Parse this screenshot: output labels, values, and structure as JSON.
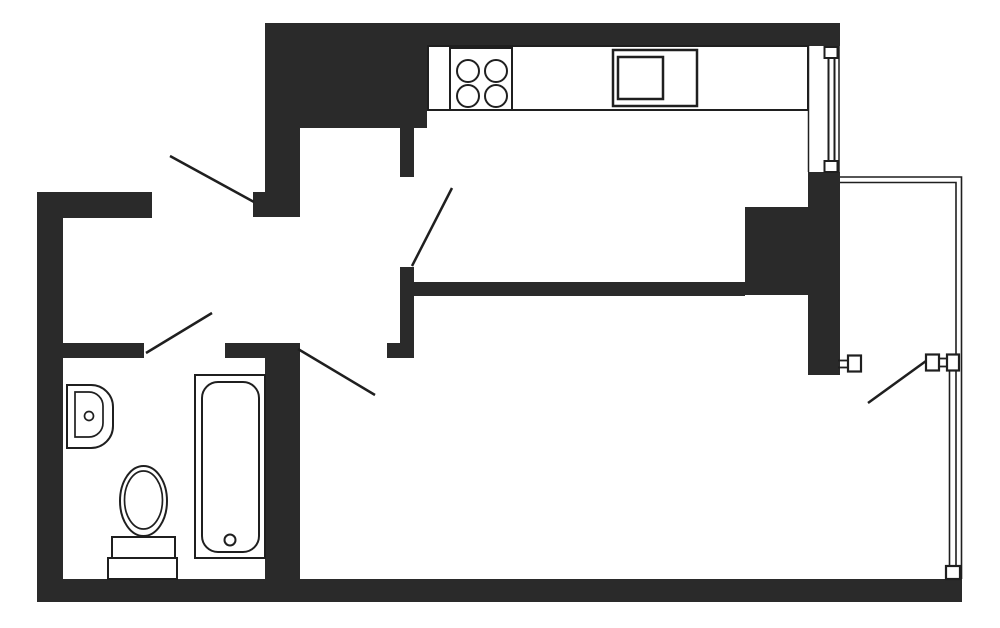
{
  "meta": {
    "description": "apartment floor plan, black walls on white, one-room flat with kitchen, bathroom, hallway and glazed balcony",
    "canvas": {
      "width": 1000,
      "height": 628,
      "background": "#ffffff"
    }
  },
  "colors": {
    "wall": "#2a2a2a",
    "line": "#1f1f1f",
    "white": "#ffffff",
    "none": "none"
  },
  "shapes": [
    {
      "name": "wall-top",
      "type": "rect",
      "x": 265,
      "y": 23,
      "w": 575,
      "h": 23,
      "fill": "wall"
    },
    {
      "name": "wall-kitchen-nw-mass",
      "type": "rect",
      "x": 265,
      "y": 23,
      "w": 162,
      "h": 105,
      "fill": "wall"
    },
    {
      "name": "wall-entry-upper",
      "type": "rect",
      "x": 265,
      "y": 128,
      "w": 35,
      "h": 89,
      "fill": "wall"
    },
    {
      "name": "wall-entry-step",
      "type": "rect",
      "x": 253,
      "y": 192,
      "w": 12,
      "h": 25,
      "fill": "wall"
    },
    {
      "name": "wall-top-left",
      "type": "rect",
      "x": 37,
      "y": 192,
      "w": 115,
      "h": 26,
      "fill": "wall"
    },
    {
      "name": "wall-left",
      "type": "rect",
      "x": 37,
      "y": 192,
      "w": 26,
      "h": 410,
      "fill": "wall"
    },
    {
      "name": "wall-bottom",
      "type": "rect",
      "x": 37,
      "y": 579,
      "w": 925,
      "h": 23,
      "fill": "wall"
    },
    {
      "name": "wall-bath-top-left",
      "type": "rect",
      "x": 63,
      "y": 343,
      "w": 81,
      "h": 15,
      "fill": "wall"
    },
    {
      "name": "wall-bath-top-right",
      "type": "rect",
      "x": 225,
      "y": 343,
      "w": 75,
      "h": 15,
      "fill": "wall"
    },
    {
      "name": "wall-bath-east",
      "type": "rect",
      "x": 265,
      "y": 343,
      "w": 35,
      "h": 236,
      "fill": "wall"
    },
    {
      "name": "wall-kitchen-door-stub",
      "type": "rect",
      "x": 400,
      "y": 128,
      "w": 14,
      "h": 49,
      "fill": "wall"
    },
    {
      "name": "wall-kitchen-door-lower",
      "type": "rect",
      "x": 400,
      "y": 267,
      "w": 14,
      "h": 91,
      "fill": "wall"
    },
    {
      "name": "wall-kitchen-door-foot",
      "type": "rect",
      "x": 387,
      "y": 343,
      "w": 27,
      "h": 15,
      "fill": "wall"
    },
    {
      "name": "wall-kitchen-living",
      "type": "rect",
      "x": 414,
      "y": 282,
      "w": 331,
      "h": 14,
      "fill": "wall"
    },
    {
      "name": "wall-living-pier",
      "type": "rect",
      "x": 745,
      "y": 207,
      "w": 65,
      "h": 88,
      "fill": "wall"
    },
    {
      "name": "wall-right",
      "type": "rect",
      "x": 808,
      "y": 172,
      "w": 32,
      "h": 203,
      "fill": "wall"
    },
    {
      "name": "kitchen-counter",
      "type": "rect",
      "x": 428,
      "y": 46,
      "w": 380,
      "h": 64,
      "fill": "white",
      "stroke": "line",
      "sw": 2
    },
    {
      "name": "stove",
      "type": "rect",
      "x": 450,
      "y": 48,
      "w": 62,
      "h": 62,
      "fill": "white",
      "stroke": "line",
      "sw": 2
    },
    {
      "name": "stove-burner-1",
      "type": "circle",
      "cx": 468,
      "cy": 71,
      "r": 11,
      "fill": "white",
      "stroke": "line",
      "sw": 2
    },
    {
      "name": "stove-burner-2",
      "type": "circle",
      "cx": 496,
      "cy": 71,
      "r": 11,
      "fill": "white",
      "stroke": "line",
      "sw": 2
    },
    {
      "name": "stove-burner-3",
      "type": "circle",
      "cx": 468,
      "cy": 96,
      "r": 11,
      "fill": "white",
      "stroke": "line",
      "sw": 2
    },
    {
      "name": "stove-burner-4",
      "type": "circle",
      "cx": 496,
      "cy": 96,
      "r": 11,
      "fill": "white",
      "stroke": "line",
      "sw": 2
    },
    {
      "name": "kitchen-sink-unit",
      "type": "rect",
      "x": 613,
      "y": 50,
      "w": 84,
      "h": 56,
      "fill": "white",
      "stroke": "line",
      "sw": 2.5
    },
    {
      "name": "kitchen-sink-basin",
      "type": "rect",
      "x": 618,
      "y": 57,
      "w": 45,
      "h": 42,
      "fill": "none",
      "stroke": "line",
      "sw": 2.5
    },
    {
      "name": "window-bay-line-left",
      "type": "line",
      "x1": 808.5,
      "y1": 46,
      "x2": 808.5,
      "y2": 172,
      "stroke": "line",
      "sw": 1.5
    },
    {
      "name": "window-bay-line-right",
      "type": "line",
      "x1": 839,
      "y1": 46,
      "x2": 839,
      "y2": 172,
      "stroke": "line",
      "sw": 1.5
    },
    {
      "name": "window-frame-left",
      "type": "line",
      "x1": 828.5,
      "y1": 57,
      "x2": 828.5,
      "y2": 162,
      "stroke": "line",
      "sw": 2
    },
    {
      "name": "window-frame-right",
      "type": "line",
      "x1": 834.5,
      "y1": 57,
      "x2": 834.5,
      "y2": 162,
      "stroke": "line",
      "sw": 2
    },
    {
      "name": "window-sill-top",
      "type": "rect",
      "x": 824.5,
      "y": 47,
      "w": 13,
      "h": 11,
      "fill": "white",
      "stroke": "line",
      "sw": 2
    },
    {
      "name": "window-sill-bottom",
      "type": "rect",
      "x": 824.5,
      "y": 161,
      "w": 13,
      "h": 11,
      "fill": "white",
      "stroke": "line",
      "sw": 2
    },
    {
      "name": "balcony-railing-outer",
      "type": "polyline",
      "points": "840,177 961.5,177 961.5,579",
      "fill": "none",
      "stroke": "line",
      "sw": 1.6
    },
    {
      "name": "balcony-railing-inner",
      "type": "polyline",
      "points": "840,182.5 956,182.5 956,579",
      "fill": "none",
      "stroke": "line",
      "sw": 1.6
    },
    {
      "name": "balcony-glazing-line",
      "type": "line",
      "x1": 949.5,
      "y1": 370,
      "x2": 949.5,
      "y2": 567,
      "stroke": "line",
      "sw": 1.6
    },
    {
      "name": "balcony-door-link-l1",
      "type": "line",
      "x1": 838,
      "y1": 360.5,
      "x2": 848,
      "y2": 360.5,
      "stroke": "line",
      "sw": 1.8
    },
    {
      "name": "balcony-door-link-l2",
      "type": "line",
      "x1": 838,
      "y1": 367.5,
      "x2": 848,
      "y2": 367.5,
      "stroke": "line",
      "sw": 1.8
    },
    {
      "name": "balcony-door-link-r1",
      "type": "line",
      "x1": 939,
      "y1": 358.5,
      "x2": 947,
      "y2": 358.5,
      "stroke": "line",
      "sw": 1.8
    },
    {
      "name": "balcony-door-link-r2",
      "type": "line",
      "x1": 939,
      "y1": 366.5,
      "x2": 947,
      "y2": 366.5,
      "stroke": "line",
      "sw": 1.8
    },
    {
      "name": "balcony-door-jamb-left",
      "type": "rect",
      "x": 848,
      "y": 355.5,
      "w": 13,
      "h": 16,
      "fill": "white",
      "stroke": "line",
      "sw": 2.2
    },
    {
      "name": "balcony-door-jamb-right",
      "type": "rect",
      "x": 926,
      "y": 354.5,
      "w": 13,
      "h": 16,
      "fill": "white",
      "stroke": "line",
      "sw": 2.2
    },
    {
      "name": "balcony-glazing-jamb",
      "type": "rect",
      "x": 947,
      "y": 354.5,
      "w": 12,
      "h": 16,
      "fill": "white",
      "stroke": "line",
      "sw": 2.2
    },
    {
      "name": "balcony-glazing-terminal",
      "type": "rect",
      "x": 946,
      "y": 566,
      "w": 14,
      "h": 13,
      "fill": "white",
      "stroke": "line",
      "sw": 2.2
    },
    {
      "name": "bath-sink-outer",
      "type": "path",
      "d": "M67,385 H91 A22,22 0 0 1 113,407 V426 A22,22 0 0 1 91,448 H67 Z",
      "fill": "white",
      "stroke": "line",
      "sw": 2
    },
    {
      "name": "bath-sink-inner",
      "type": "path",
      "d": "M75,392 H89 A14,14 0 0 1 103,406 V423 A14,14 0 0 1 89,437 H75 Z",
      "fill": "none",
      "stroke": "line",
      "sw": 1.7
    },
    {
      "name": "bath-sink-drain",
      "type": "circle",
      "cx": 89,
      "cy": 416,
      "r": 4.5,
      "fill": "white",
      "stroke": "line",
      "sw": 1.7
    },
    {
      "name": "toilet-base",
      "type": "rect",
      "x": 108,
      "y": 558,
      "w": 69,
      "h": 21,
      "fill": "white",
      "stroke": "line",
      "sw": 2
    },
    {
      "name": "toilet-tank",
      "type": "rect",
      "x": 112,
      "y": 537,
      "w": 63,
      "h": 21,
      "fill": "white",
      "stroke": "line",
      "sw": 2
    },
    {
      "name": "toilet-bowl-outer",
      "type": "ellipse",
      "cx": 143.5,
      "cy": 501,
      "rx": 23.5,
      "ry": 35,
      "fill": "white",
      "stroke": "line",
      "sw": 2
    },
    {
      "name": "toilet-bowl-inner",
      "type": "ellipse",
      "cx": 143.5,
      "cy": 500,
      "rx": 19,
      "ry": 29,
      "fill": "none",
      "stroke": "line",
      "sw": 1.7
    },
    {
      "name": "bathtub-outer",
      "type": "rect",
      "x": 195,
      "y": 375,
      "w": 70,
      "h": 183,
      "fill": "white",
      "stroke": "line",
      "sw": 2
    },
    {
      "name": "bathtub-inner",
      "type": "rect",
      "x": 202,
      "y": 382,
      "w": 57,
      "h": 170,
      "rx": 16,
      "fill": "none",
      "stroke": "line",
      "sw": 2
    },
    {
      "name": "bathtub-drain",
      "type": "circle",
      "cx": 230,
      "cy": 540,
      "r": 5.5,
      "fill": "white",
      "stroke": "line",
      "sw": 2
    },
    {
      "name": "entry-door-swing",
      "type": "line",
      "x1": 170,
      "y1": 156,
      "x2": 254,
      "y2": 202,
      "stroke": "line",
      "sw": 2.5
    },
    {
      "name": "kitchen-door-swing",
      "type": "line",
      "x1": 412,
      "y1": 266,
      "x2": 452,
      "y2": 188,
      "stroke": "line",
      "sw": 2.5
    },
    {
      "name": "bathroom-door-swing",
      "type": "line",
      "x1": 146,
      "y1": 353,
      "x2": 212,
      "y2": 313,
      "stroke": "line",
      "sw": 2.5
    },
    {
      "name": "living-door-swing",
      "type": "line",
      "x1": 298,
      "y1": 349,
      "x2": 375,
      "y2": 395,
      "stroke": "line",
      "sw": 2.5
    },
    {
      "name": "balcony-door-swing",
      "type": "line",
      "x1": 868,
      "y1": 403,
      "x2": 926,
      "y2": 361,
      "stroke": "line",
      "sw": 2.5
    }
  ]
}
